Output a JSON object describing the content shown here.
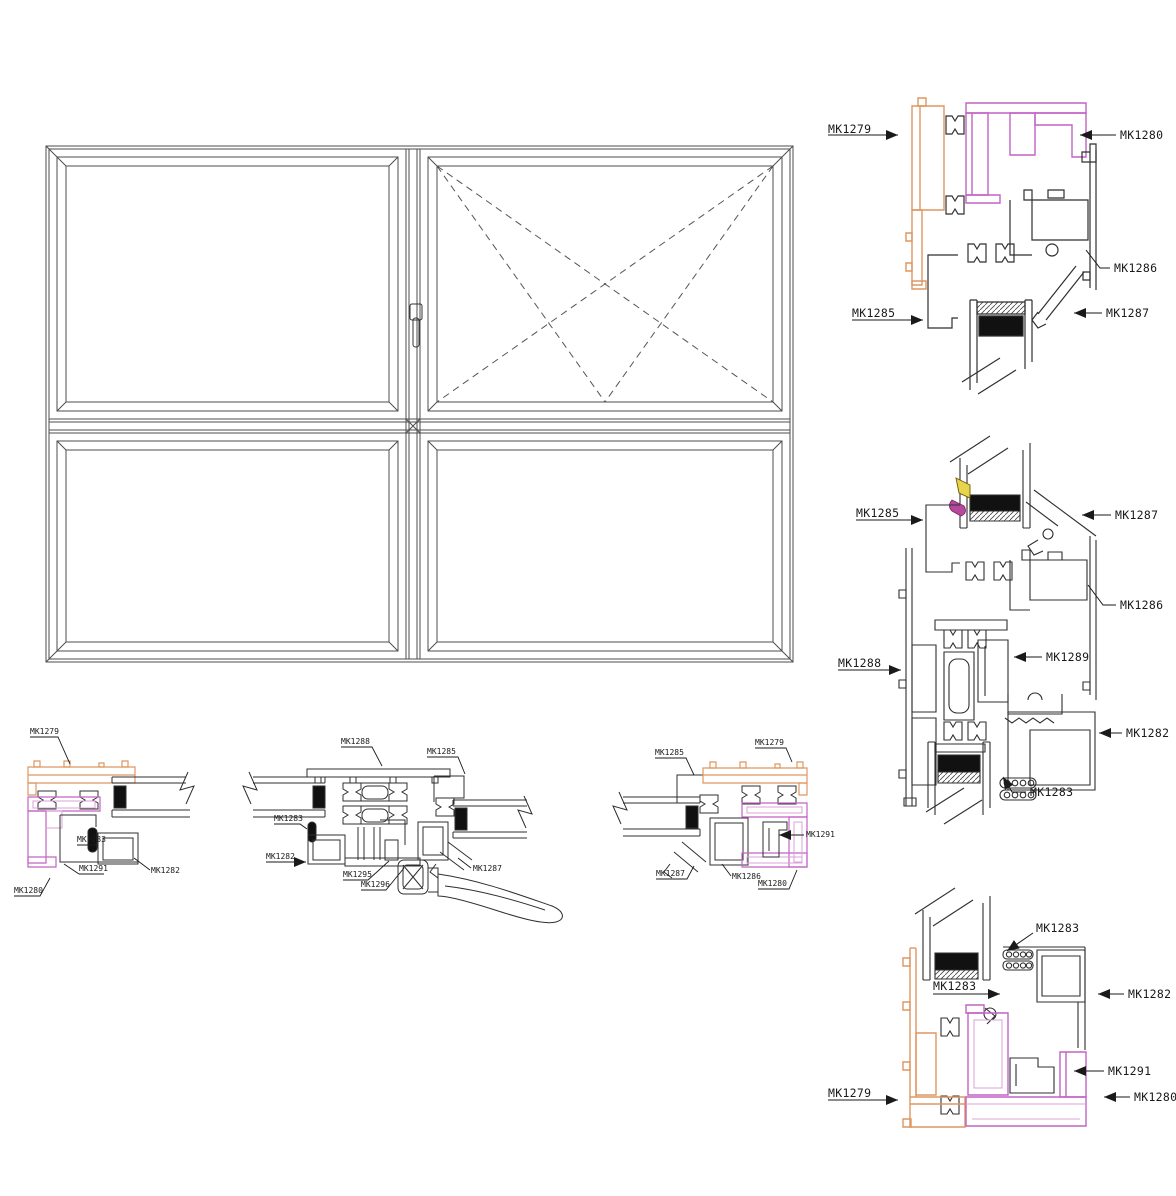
{
  "document": {
    "type": "aluminum-window-profile-section-drawing",
    "background": "#ffffff"
  },
  "colors": {
    "frame_profile_orange": "#DE9660",
    "sash_profile_purple": "#C263C4",
    "sash_profile_pink": "#D9A0D9",
    "hardware_yellow": "#E8D44C",
    "hardware_magenta": "#B8489C",
    "line_black": "#2F2F2F",
    "glass_spacer_black": "#111111"
  },
  "elevation": {
    "panes": 4,
    "opening_pane": "top-right",
    "opening_symbol": "dashed-casement-cross"
  },
  "labels": {
    "detail_top_right": [
      "MK1279",
      "MK1280",
      "MK1286",
      "MK1285",
      "MK1287"
    ],
    "detail_middle_right": [
      "MK1285",
      "MK1287",
      "MK1286",
      "MK1288",
      "MK1289",
      "MK1282",
      "MK1283"
    ],
    "detail_bottom_right": [
      "MK1283",
      "MK1282",
      "MK1283",
      "MK1291",
      "MK1279",
      "MK1280"
    ],
    "detail_left_1": [
      "MK1279",
      "MK1283",
      "MK1291",
      "MK1282",
      "MK1280"
    ],
    "detail_left_2": [
      "MK1288",
      "MK1285",
      "MK1283",
      "MK1282",
      "MK1295",
      "MK1296",
      "MK1287"
    ],
    "detail_left_3": [
      "MK1285",
      "MK1279",
      "MK1291",
      "MK1287",
      "MK1286",
      "MK1280"
    ]
  }
}
